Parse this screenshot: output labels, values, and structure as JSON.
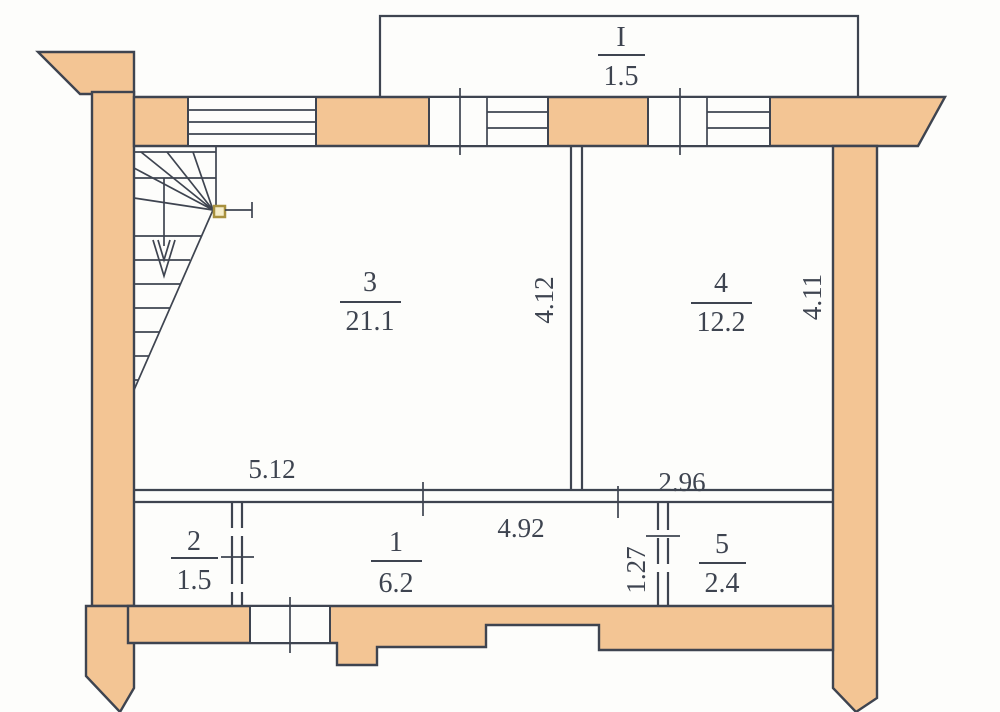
{
  "plan": {
    "balcony": {
      "label": "I",
      "area": "1.5"
    },
    "rooms": {
      "r1": {
        "number": "1",
        "area": "6.2"
      },
      "r2": {
        "number": "2",
        "area": "1.5"
      },
      "r3": {
        "number": "3",
        "area": "21.1"
      },
      "r4": {
        "number": "4",
        "area": "12.2"
      },
      "r5": {
        "number": "5",
        "area": "2.4"
      }
    },
    "dimensions": {
      "bottom_left": "5.12",
      "bottom_center": "4.92",
      "bottom_right": "2.96",
      "center_wall": "4.12",
      "right_wall": "4.11",
      "partition": "1.27"
    },
    "colors": {
      "wall_fill": "#f3c594",
      "line": "#3e4450",
      "background": "#fdfdfb",
      "marker_fill": "#f5edc9",
      "marker_stroke": "#a8913f"
    }
  }
}
